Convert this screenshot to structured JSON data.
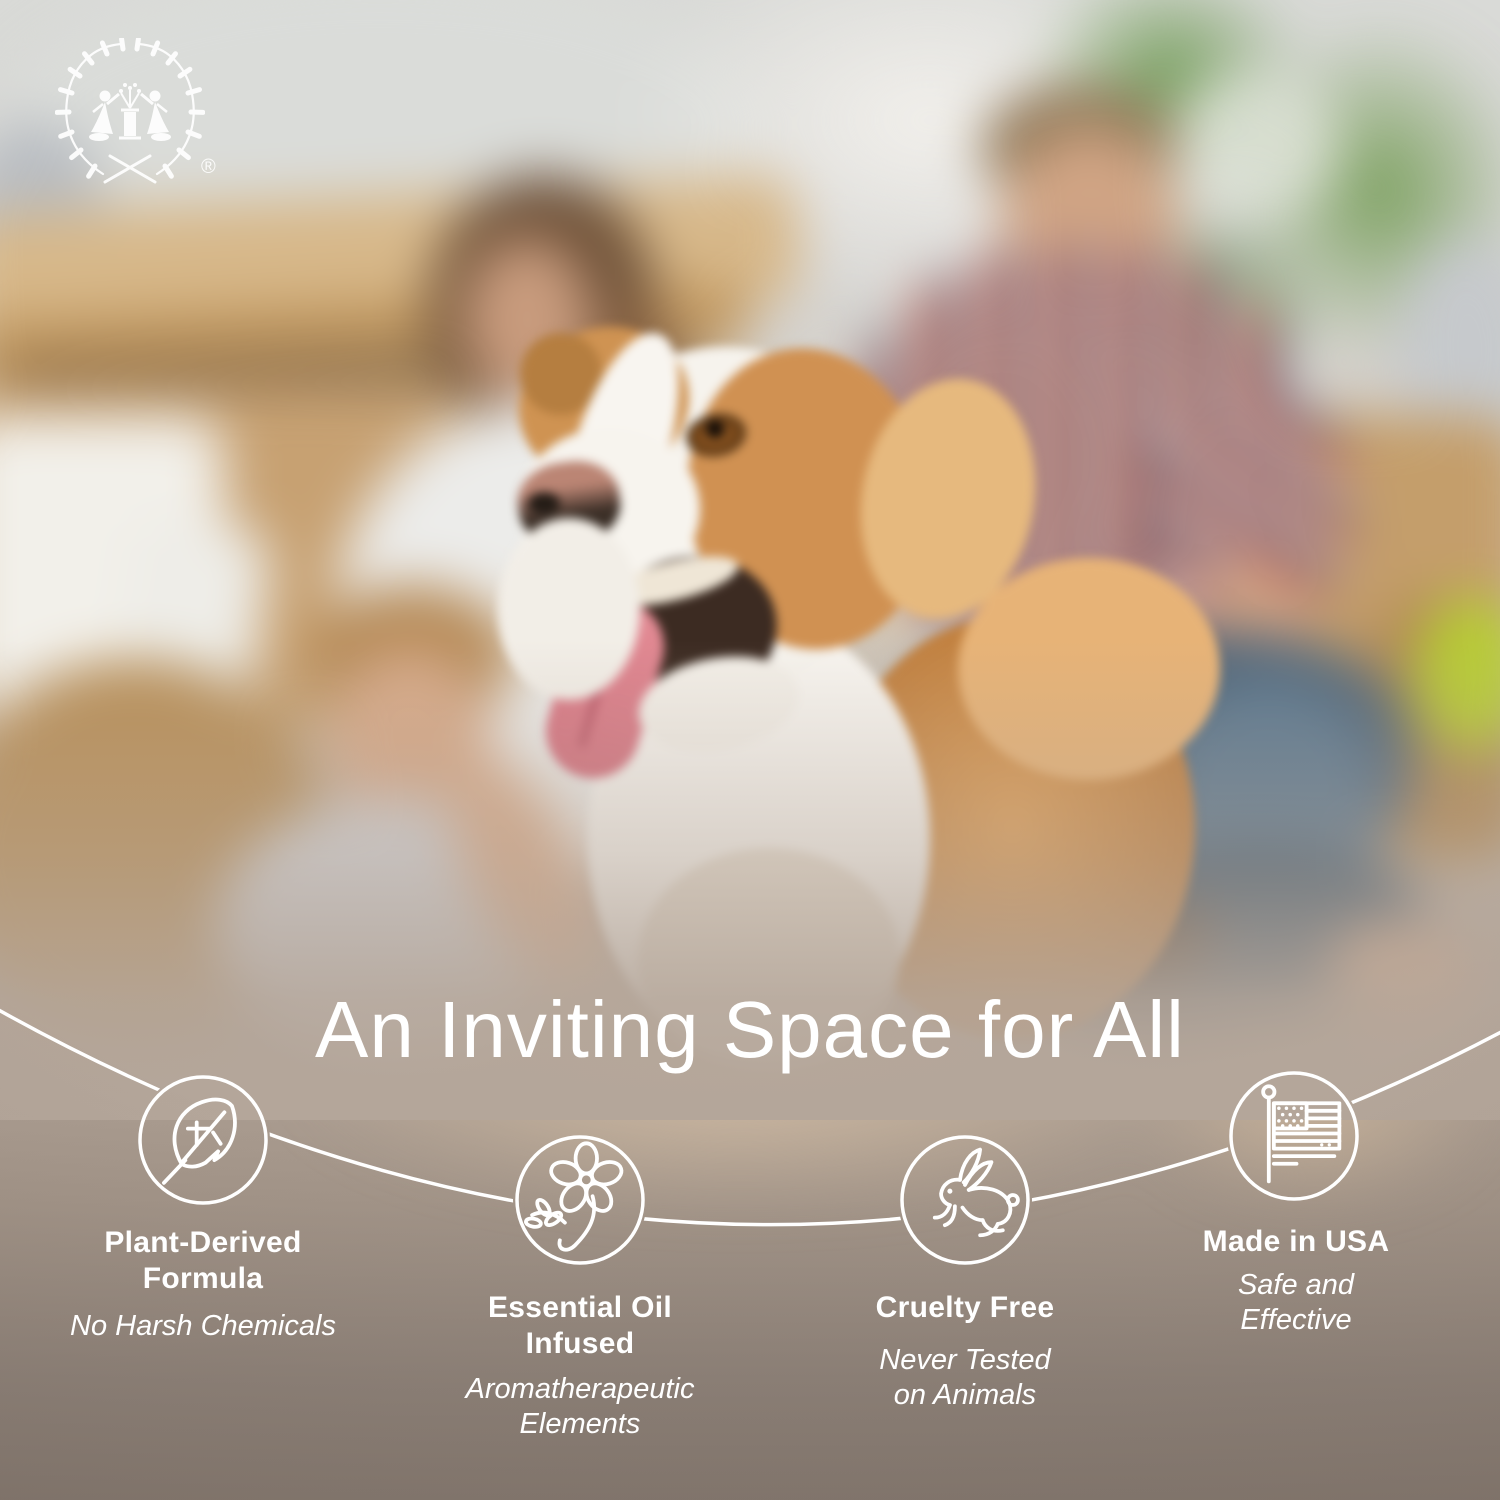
{
  "brand": {
    "logo": "wreath-with-two-figures-emblem",
    "registered_mark": "®"
  },
  "headline": {
    "text": "An Inviting Space for All"
  },
  "features": [
    {
      "icon": "leaf-icon",
      "title_lines": [
        "Plant-Derived",
        "Formula"
      ],
      "subtitle_lines": [
        "No Harsh Chemicals"
      ]
    },
    {
      "icon": "flower-icon",
      "title_lines": [
        "Essential Oil",
        "Infused"
      ],
      "subtitle_lines": [
        "Aromatherapeutic",
        "Elements"
      ]
    },
    {
      "icon": "rabbit-icon",
      "title_lines": [
        "Cruelty Free"
      ],
      "subtitle_lines": [
        "Never Tested",
        "on Animals"
      ]
    },
    {
      "icon": "us-flag-icon",
      "title_lines": [
        "Made in USA"
      ],
      "subtitle_lines": [
        "Safe and",
        "Effective"
      ]
    }
  ],
  "colors": {
    "text": "#ffffff",
    "connector_line": "#ffffff",
    "band_top": "#b2a499",
    "band_bottom": "#877b70"
  },
  "scene": {
    "description": "Blurred photo of a family of four with a brown and white dog among cardboard moving boxes"
  }
}
